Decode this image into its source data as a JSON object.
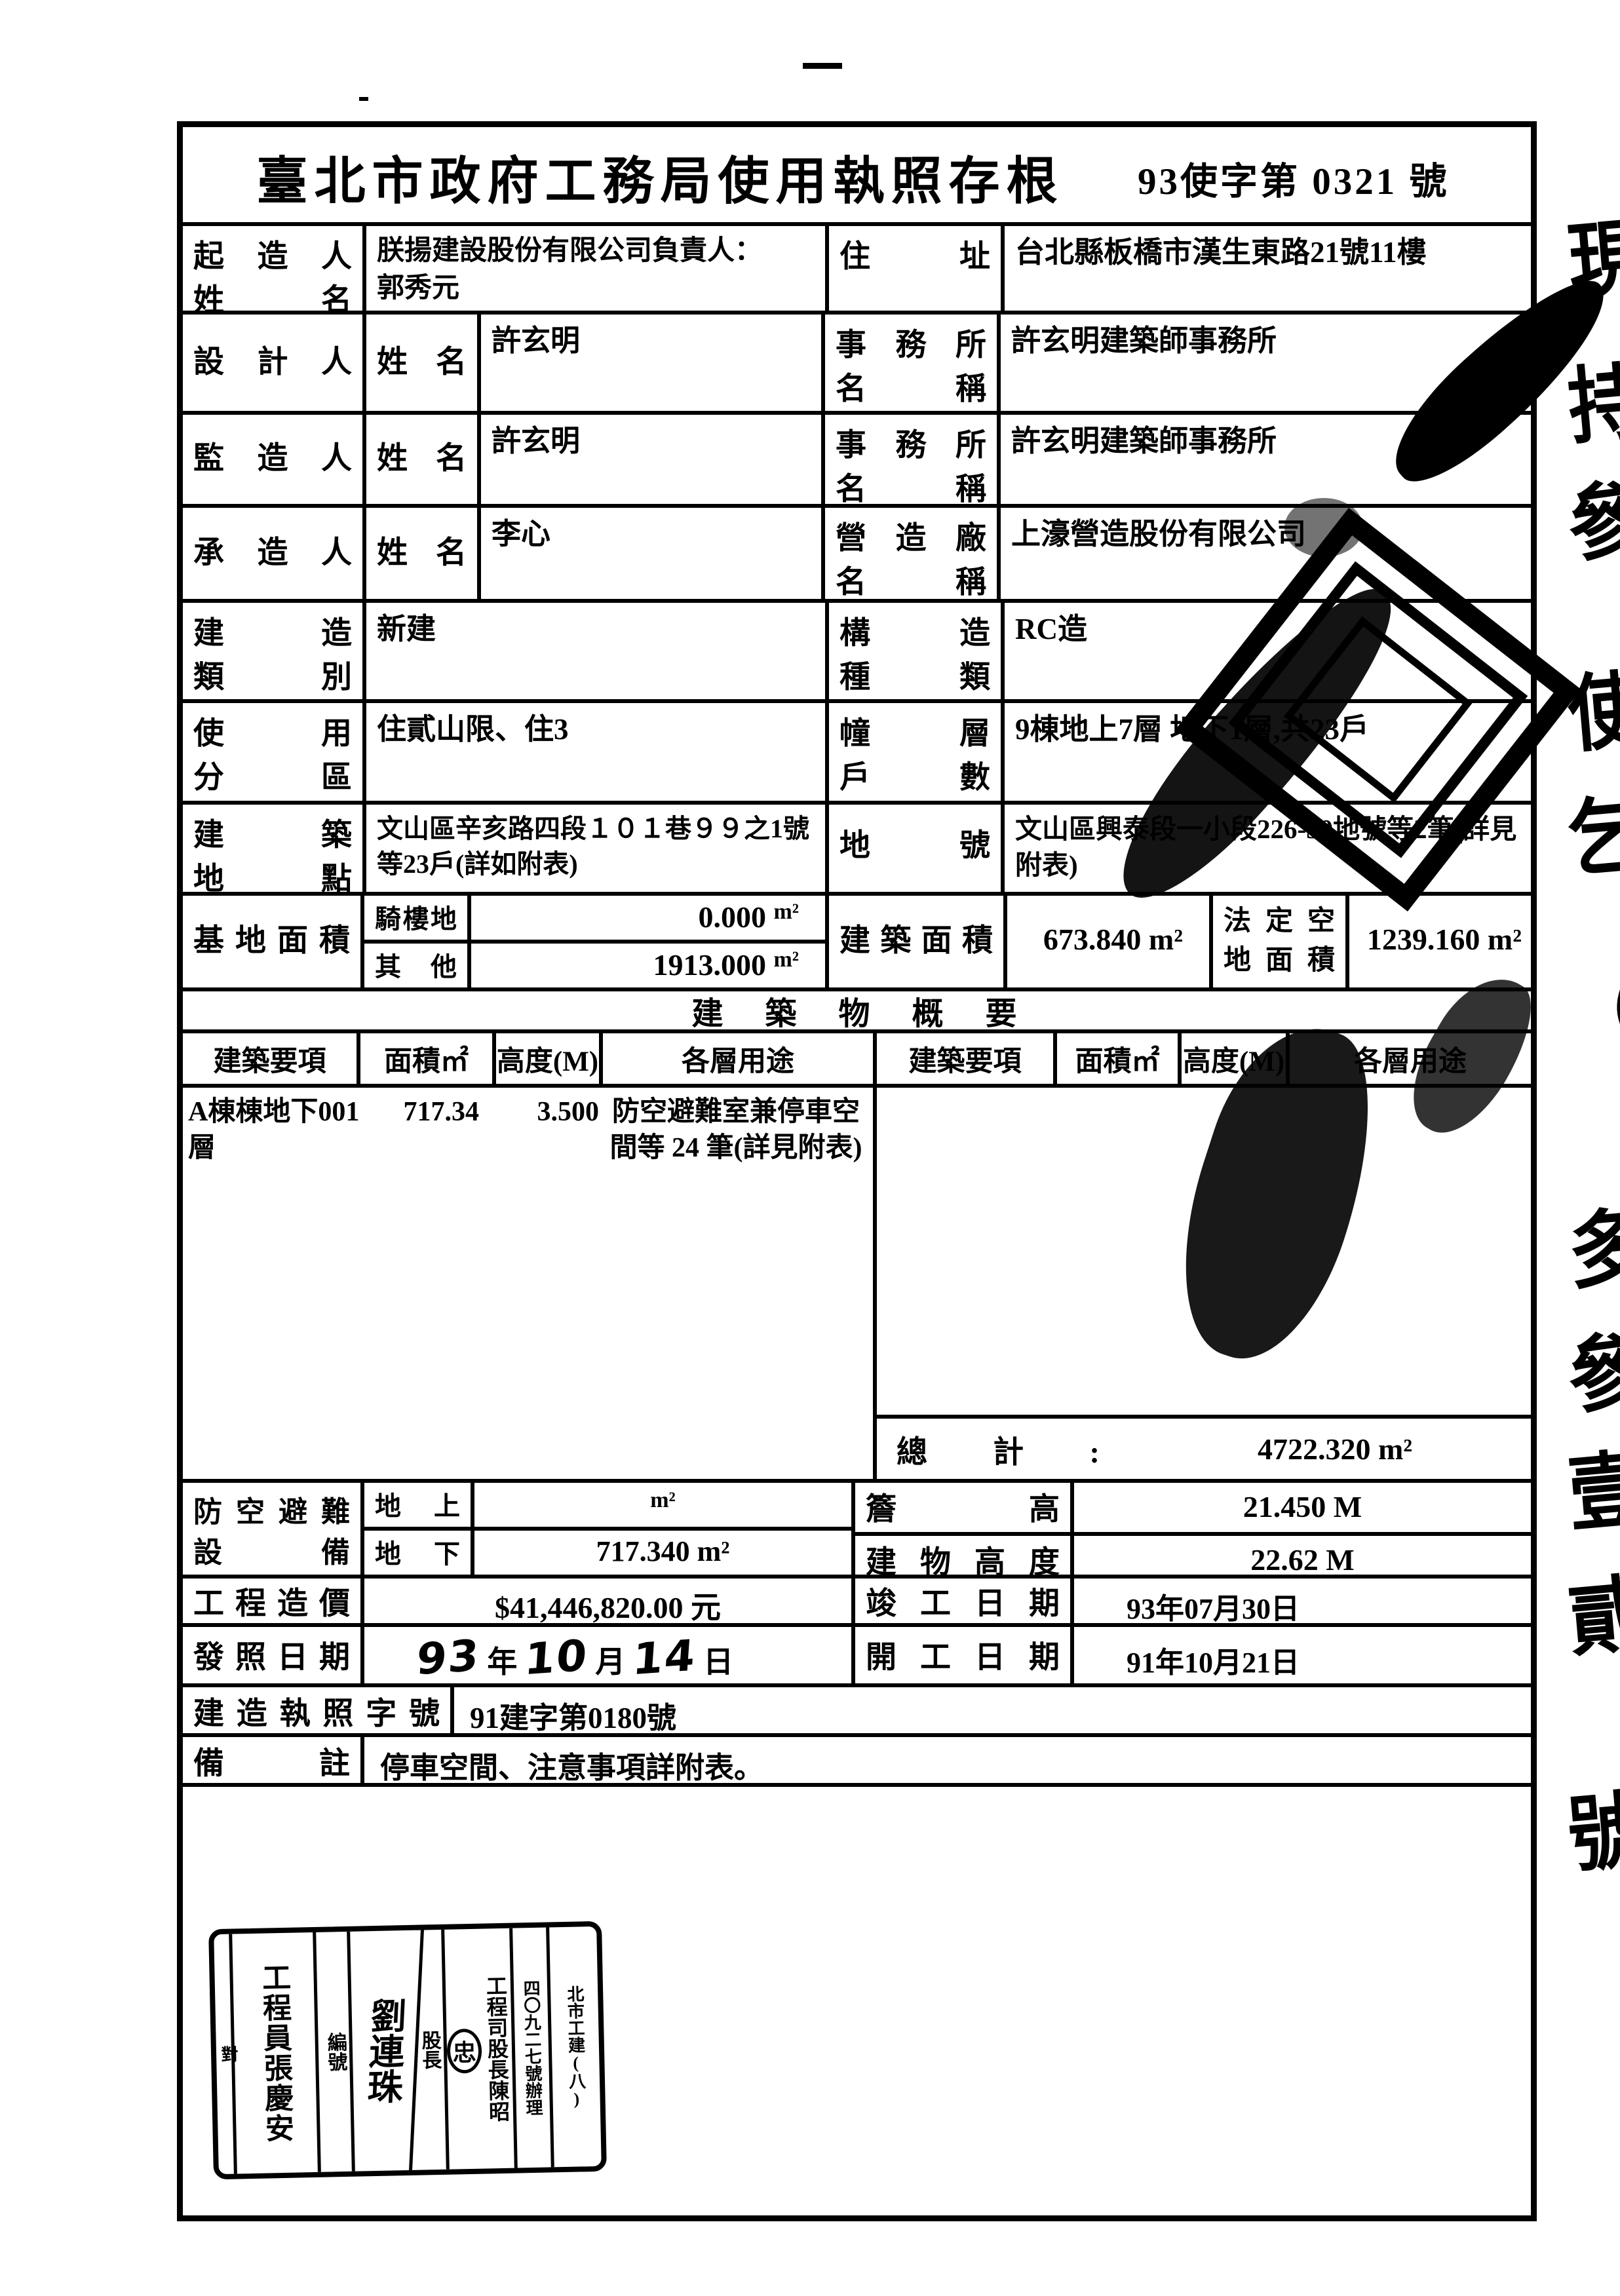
{
  "doc": {
    "title": "臺北市政府工務局使用執照存根",
    "doc_no": "93使字第 0321 號"
  },
  "row1": {
    "label": "起 造 人\n姓 名",
    "value": "朕揚建設股份有限公司負責人：\n郭秀元",
    "right_label": "住 址",
    "right_value": "台北縣板橋市漢生東路21號11樓"
  },
  "row2": {
    "label": "設 計 人",
    "sub_label": "姓 名",
    "value": "許玄明",
    "right_label": "事 務 所\n名 稱",
    "right_value": "許玄明建築師事務所"
  },
  "row3": {
    "label": "監 造 人",
    "sub_label": "姓 名",
    "value": "許玄明",
    "right_label": "事 務 所\n名 稱",
    "right_value": "許玄明建築師事務所"
  },
  "row4": {
    "label": "承 造 人",
    "sub_label": "姓 名",
    "value": "李心",
    "right_label": "營 造 廠\n名 稱",
    "right_value": "上濠營造股份有限公司"
  },
  "row5": {
    "label": "建 造\n類 別",
    "value": "新建",
    "right_label": "構 造\n種 類",
    "right_value": "RC造"
  },
  "row6": {
    "label": "使 用\n分 區",
    "value": "住貳山限、住3",
    "right_label": "幢 層\n戶 數",
    "right_value": "9棟地上7層 地下1層,共23戶"
  },
  "row7": {
    "label": "建 築\n地 點",
    "value": "文山區辛亥路四段１０１巷９９之1號等23戶(詳如附表)",
    "right_label": "地 號",
    "right_value": "文山區興泰段一小段226-30地號等2筆(詳見附表)"
  },
  "row8": {
    "label": "基地面積",
    "sub1_label": "騎樓地",
    "sub1_value": "0.000",
    "sub1_unit": "m²",
    "sub2_label": "其 他",
    "sub2_value": "1913.000",
    "sub2_unit": "m²",
    "mid_label": "建築面積",
    "mid_value": "673.840 m²",
    "right_label": "法定空\n地面積",
    "right_value": "1239.160 m²"
  },
  "summary": {
    "section_title": "建　築　物　概　要",
    "headers": [
      "建築要項",
      "面積㎡",
      "高度(M)",
      "各層用途"
    ],
    "entry": {
      "item": "A棟棟地下001層",
      "area": "717.34",
      "height": "3.500",
      "usage": "防空避難室兼停車空間等 24 筆(詳見附表)"
    },
    "total_label": "總 計 :",
    "total_value": "4722.320 m²"
  },
  "lower": {
    "air_label": "防空避難\n設 備",
    "air_above_label": "地 上",
    "air_above_value": "m²",
    "air_below_label": "地 下",
    "air_below_value": "717.340 m²",
    "eave_label": "簷 高",
    "eave_value": "21.450 M",
    "bheight_label": "建物高度",
    "bheight_value": "22.62 M",
    "cost_label": "工程造價",
    "cost_value": "$41,446,820.00 元",
    "completion_label": "竣工日期",
    "completion_value": "93年07月30日",
    "issue_label": "發照日期",
    "issue_y": "93",
    "issue_y_unit": "年",
    "issue_m": "10",
    "issue_m_unit": "月",
    "issue_d": "14",
    "issue_d_unit": "日",
    "start_label": "開工日期",
    "start_value": "91年10月21日",
    "permit_label": "建造執照字號",
    "permit_value": "91建字第0180號",
    "note_label": "備 註",
    "note_value": "停車空間、注意事項詳附表。"
  },
  "stamp_box": {
    "columns": [
      "對",
      "工程員張慶安",
      "編號",
      "劉連珠",
      "股長",
      "工程司股長陳昭"
    ],
    "seal_char": "忠",
    "side_col_a": "四〇九二七號辦理",
    "side_col_b": "北市工建(八)"
  },
  "margin_strip": {
    "glyphs": [
      "現",
      "持",
      "參",
      "使",
      "乞",
      "（",
      "多",
      "參",
      "壹",
      "貳",
      "號"
    ]
  }
}
